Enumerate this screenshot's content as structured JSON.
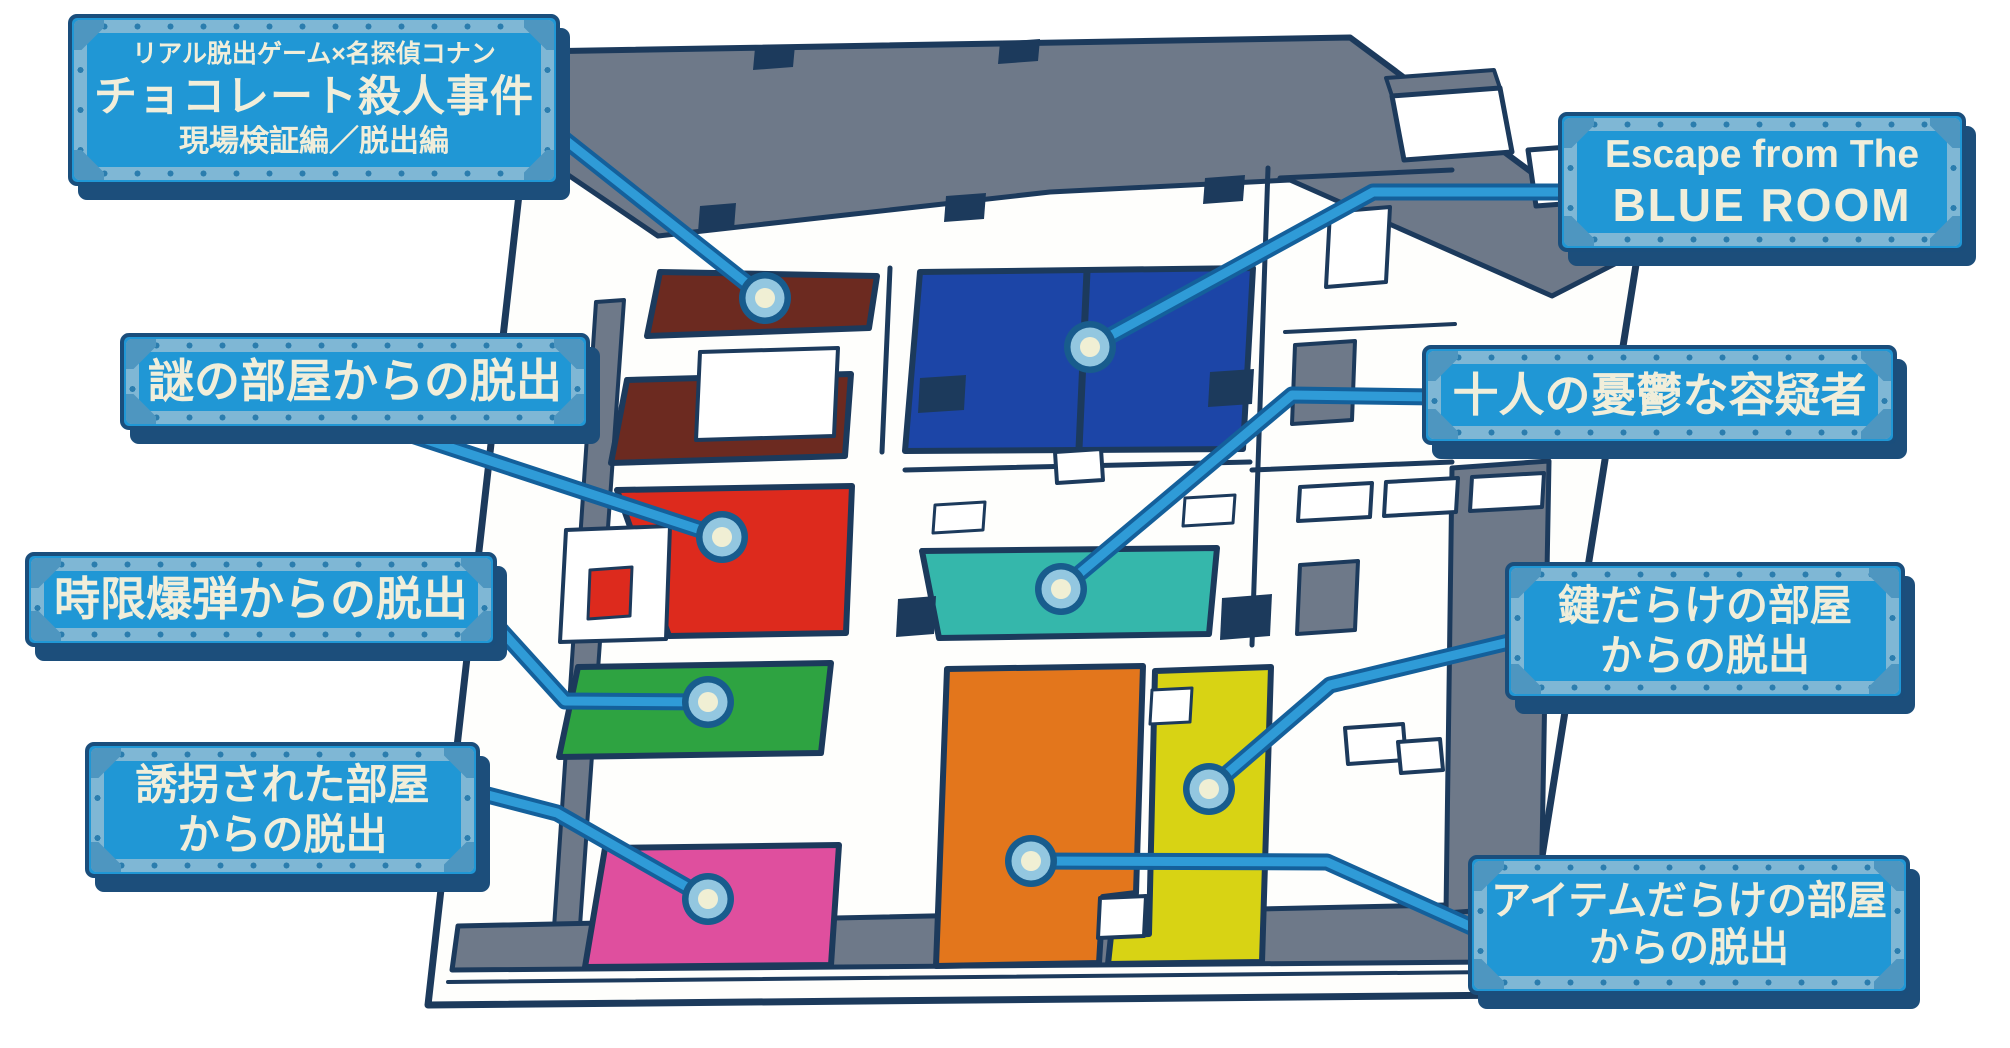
{
  "palette": {
    "plate_fill": "#2097D5",
    "plate_frame": "#7FB7D5",
    "plate_corner": "#4E96C0",
    "plate_border": "#1A4E7C",
    "plate_text": "#F1EEDA",
    "connector_outer": "#14609B",
    "connector_inner": "#2F9BD7",
    "marker_ring": "#185C8D",
    "marker_mid": "#93C7E0",
    "marker_center": "#F0EFD4",
    "ink": "#1C3A5C",
    "outside_grey": "#6E7989",
    "wall_white": "#FEFEFC"
  },
  "room_colors": {
    "conan": "#6C2A20",
    "blue": "#1C45A7",
    "nazo": "#DD2A1D",
    "suspects": "#35B7AB",
    "jigen": "#2EA341",
    "yukai": "#DF4F9E",
    "items": "#E3761C",
    "keys": "#D8D314"
  },
  "labels": {
    "conan": {
      "line1": "リアル脱出ゲーム×名探偵コナン",
      "line2": "チョコレート殺人事件",
      "line3": "現場検証編／脱出編"
    },
    "nazo": {
      "line1": "謎の部屋からの脱出"
    },
    "jigen": {
      "line1": "時限爆弾からの脱出"
    },
    "yukai": {
      "line1": "誘拐された部屋",
      "line2": "からの脱出"
    },
    "blue_room": {
      "line1": "Escape from The",
      "line2": "BLUE ROOM"
    },
    "suspects": {
      "line1": "十人の憂鬱な容疑者"
    },
    "keys": {
      "line1": "鍵だらけの部屋",
      "line2": "からの脱出"
    },
    "items": {
      "line1": "アイテムだらけの部屋",
      "line2": "からの脱出"
    }
  }
}
